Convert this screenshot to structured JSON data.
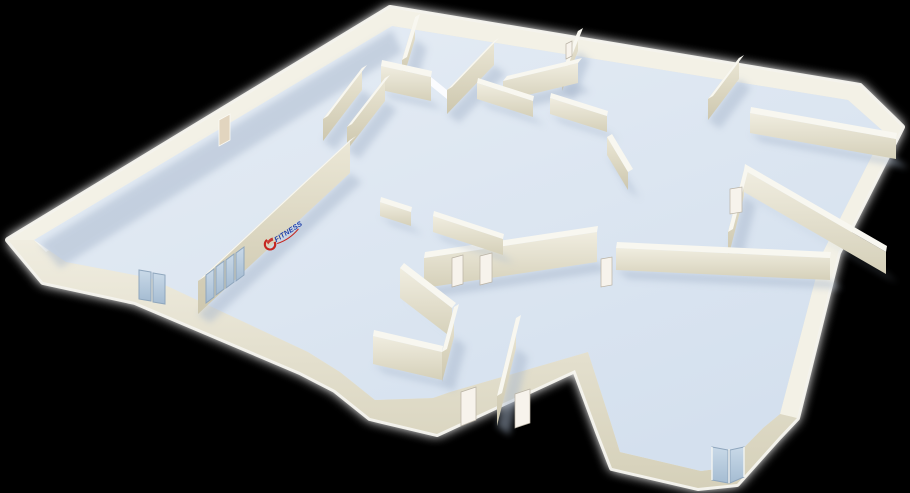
{
  "scene": {
    "title": "3D floor plan view",
    "description": "Perspective 3D rendering of a gym floor plan with cream walls and pale blue floors on a black background"
  },
  "branding": {
    "logo_text": "FITNESS",
    "logo_text_color": "#1e3ea8",
    "logo_swoosh_color": "#c5261f"
  },
  "palette": {
    "background": "#000000",
    "glow": "#ffffff",
    "floor_a": "#e6edf5",
    "floor_b": "#d4e0ee",
    "wall_top": "#f8f7f0",
    "wall_front_a": "#f0ede0",
    "wall_front_b": "#d5d0b9",
    "wall_ns_a": "#ebe7d6",
    "wall_ns_b": "#cdc7ae",
    "glass_a": "#c9d9e8",
    "glass_b": "#a5bcd2",
    "glass_frame": "#8fa6bd",
    "door_white": "#f7f3ec",
    "door_beige": "#e2d5bf",
    "shadow": "#a8b7cc",
    "logo_blue": "#1e3ea8",
    "logo_red": "#c5261f"
  },
  "elements": {
    "glass_window_groups": 2,
    "glass_entrance_doors": 1,
    "interior_white_doors": 6,
    "doorway_openings": 3,
    "exterior_door_beige": 1
  }
}
